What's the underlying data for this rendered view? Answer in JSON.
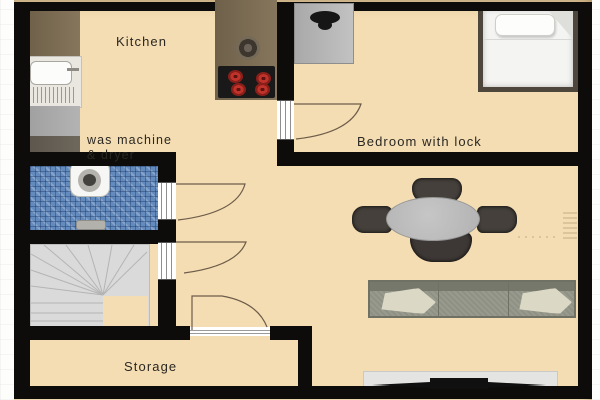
{
  "plan": {
    "type": "apartment-floor-plan",
    "rooms": {
      "kitchen": {
        "label": "Kitchen"
      },
      "laundry": {
        "label_line1": "was machine",
        "label_line2": "& dryer"
      },
      "bedroom": {
        "label": "Bedroom with lock"
      },
      "storage": {
        "label": "Storage"
      }
    },
    "furniture": [
      "kitchen-counter",
      "kitchen-sink-basin",
      "drainboard",
      "washer-dryer-unit",
      "island-counter",
      "round-counter-sink",
      "stove-four-burners",
      "bathroom-toilet",
      "mosaic-tiled-bathroom-floor",
      "shower-drain-step",
      "winder-staircase",
      "double-bed",
      "bed-pillow",
      "folded-blanket",
      "bedside-appliance",
      "round-dining-table",
      "dining-chair-top",
      "dining-chair-bottom",
      "dining-chair-left",
      "dining-chair-right",
      "three-seat-sofa",
      "sofa-cushion-left",
      "sofa-cushion-right",
      "tv-sideboard",
      "flatscreen-tv",
      "radiator"
    ],
    "doors": [
      "kitchen-to-bedroom-door",
      "hall-to-bathroom-door",
      "hall-to-stairs-door",
      "hall-to-storage-door"
    ],
    "colors": {
      "floor_beige": "#f4ddb3",
      "wall_black": "#0e0c0a",
      "counter_brown": "#7c6c52",
      "stove_black": "#191919",
      "burner_red": "#bf332b",
      "bathroom_tile_blue": "#638bbd",
      "stairs_gray": "#dadada",
      "bed_frame": "#4d463c",
      "table_gray": "#bcbcbc",
      "chair_dark": "#45403b",
      "sofa_graygreen": "#8e9183",
      "cushion_cream": "#dcd8c6",
      "tv_black": "#101010",
      "door_arc_brown": "#6d5c49"
    }
  }
}
